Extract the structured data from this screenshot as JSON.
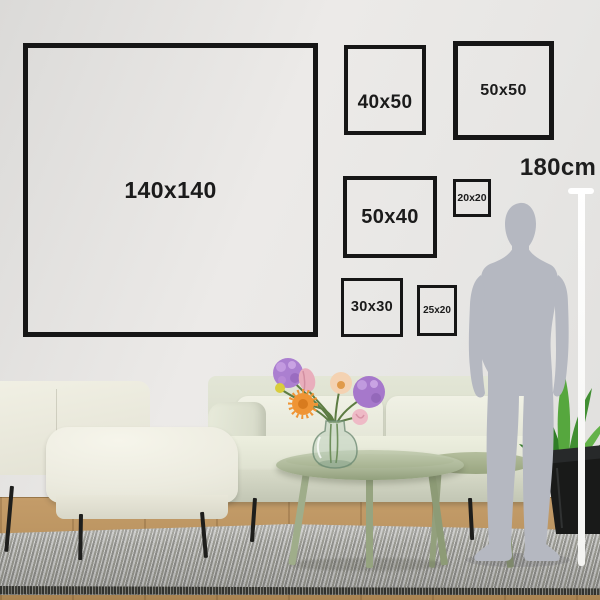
{
  "frames": [
    {
      "label": "140x140"
    },
    {
      "label": "40x50"
    },
    {
      "label": "50x50"
    },
    {
      "label": "50x40"
    },
    {
      "label": "20x20"
    },
    {
      "label": "30x30"
    },
    {
      "label": "25x20"
    }
  ],
  "height_marker": {
    "label": "180cm"
  },
  "colors": {
    "frame_border": "#161616",
    "label_text": "#1b1b1b",
    "wall": "#e8e7e5",
    "measure_line": "#ffffff",
    "person_silhouette": "#b5b8c1",
    "sofa_fabric": "#e6e8d9",
    "armchair_fabric": "#f1f0e4",
    "table_sage": "#aab695",
    "rug_gray": "#a3a3a1",
    "wood_floor": "#b8945f",
    "plant_green": "#4c9a38",
    "plant_pot": "#1b1c1b",
    "flower_purple": "#ab7fd0",
    "flower_orange": "#ef9434",
    "flower_pink": "#e9aebc",
    "flower_yellow": "#d9cd3c"
  }
}
